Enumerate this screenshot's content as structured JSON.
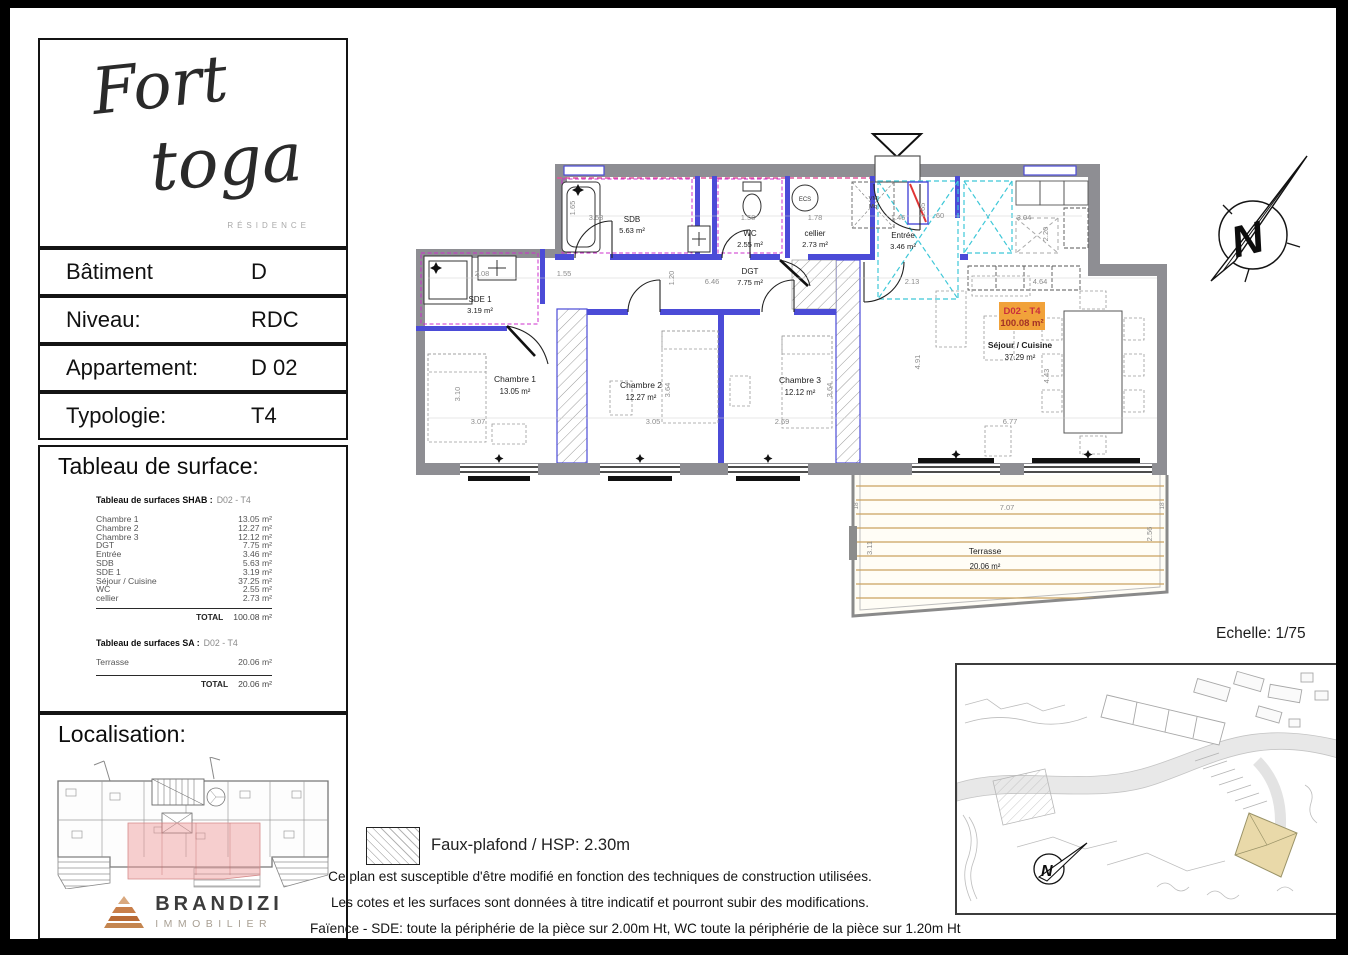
{
  "sheet": {
    "logo": {
      "word1": "Fort",
      "word2": "toga",
      "subtitle": "RÉSIDENCE"
    },
    "info_rows": [
      {
        "label": "Bâtiment",
        "value": "D"
      },
      {
        "label": "Niveau:",
        "value": "RDC"
      },
      {
        "label": "Appartement:",
        "value": "D 02"
      },
      {
        "label": "Typologie:",
        "value": "T4"
      }
    ],
    "surface": {
      "title": "Tableau de surface:",
      "shab_header": "Tableau de surfaces SHAB :",
      "shab_code": "D02 - T4",
      "shab_rows": [
        {
          "name": "Chambre 1",
          "area": "13.05 m²"
        },
        {
          "name": "Chambre 2",
          "area": "12.27 m²"
        },
        {
          "name": "Chambre 3",
          "area": "12.12 m²"
        },
        {
          "name": "DGT",
          "area": "7.75 m²"
        },
        {
          "name": "Entrée",
          "area": "3.46 m²"
        },
        {
          "name": "SDB",
          "area": "5.63 m²"
        },
        {
          "name": "SDE 1",
          "area": "3.19 m²"
        },
        {
          "name": "Séjour / Cuisine",
          "area": "37.25 m²"
        },
        {
          "name": "WC",
          "area": "2.55 m²"
        },
        {
          "name": "cellier",
          "area": "2.73 m²"
        }
      ],
      "total_label": "TOTAL",
      "shab_total": "100.08 m²",
      "sa_header": "Tableau de surfaces SA :",
      "sa_code": "D02 - T4",
      "sa_row": {
        "name": "Terrasse",
        "area": "20.06 m²"
      },
      "sa_total": "20.06 m²"
    },
    "localisation_title": "Localisation:",
    "brand": {
      "name": "BRANDIZI",
      "tagline": "IMMOBILIER"
    }
  },
  "plan": {
    "tag": {
      "code": "D02 - T4",
      "area": "100.08 m²"
    },
    "rooms": {
      "sdb": {
        "name": "SDB",
        "area": "5.63 m²"
      },
      "wc": {
        "name": "WC",
        "area": "2.55 m²"
      },
      "cellier": {
        "name": "cellier",
        "area": "2.73 m²"
      },
      "entree": {
        "name": "Entrée",
        "area": "3.46 m²"
      },
      "dgt": {
        "name": "DGT",
        "area": "7.75 m²"
      },
      "sde1": {
        "name": "SDE 1",
        "area": "3.19 m²"
      },
      "ch1": {
        "name": "Chambre 1",
        "area": "13.05 m²"
      },
      "ch2": {
        "name": "Chambre 2",
        "area": "12.27 m²"
      },
      "ch3": {
        "name": "Chambre 3",
        "area": "12.12 m²"
      },
      "sejour": {
        "name": "Séjour / Cuisine",
        "area": "37.29 m²"
      },
      "terrasse": {
        "name": "Terrasse",
        "area": "20.06 m²"
      }
    },
    "annotations": {
      "ecs": "ECS",
      "vm": "VM",
      "mq": "Mq"
    },
    "dims": {
      "sdb_w": "3.58",
      "sdb_h": "1.65",
      "wc_w": "1.58",
      "cellier_w": "1.78",
      "entree_w": "1.46",
      "entree_h": "1.65",
      "entree_w2": ".60",
      "kitchen_w": "3.04",
      "kitchen_h": "2.20",
      "hall_w": "2.13",
      "sejour_top": "4.64",
      "dgt_w": "6.46",
      "dgt_h": "1.20",
      "sde_w": "2.08",
      "sde_door": "1.55",
      "ch1_w": "3.07",
      "ch1_h": "3.10",
      "ch2_w": "3.05",
      "ch2_h": "3.64",
      "ch3_w": "2.69",
      "ch3_h": "3.64",
      "sejour_h": "4.91",
      "sejour_w": "6.77",
      "table_h": "4.43",
      "terrasse_w": "7.07",
      "terrasse_hl": "3.11",
      "terrasse_hr": "2.56",
      "terrasse_edge": "18"
    }
  },
  "north_letter": "N",
  "scale_label": "Echelle: 1/75",
  "legend_label": "Faux-plafond / HSP: 2.30m",
  "disclaimer": [
    "Ce plan est susceptible d'être modifié en fonction des techniques de construction utilisées.",
    "Les cotes et les surfaces sont données à titre indicatif et pourront subir des modifications.",
    "Faïence - SDE: toute la périphérie de la pièce sur 2.00m Ht, WC toute la périphérie de la pièce sur 1.20m Ht"
  ],
  "colors": {
    "wall_gray": "#8e8e93",
    "wall_blue": "#4b4bd7",
    "faience_magenta": "#cc2fcc",
    "entry_cyan": "#3ec8d8",
    "deck_tan": "#c9a35f",
    "tag_orange": "#f1a23a",
    "tag_red": "#c9303c"
  }
}
